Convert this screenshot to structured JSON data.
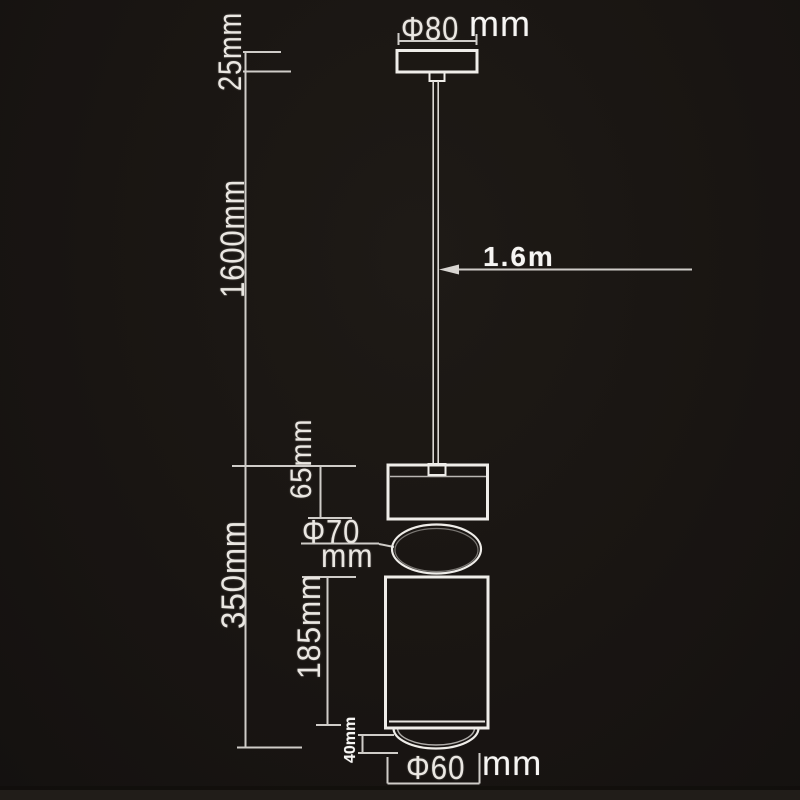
{
  "page": {
    "background": "#191512",
    "dim_line_color": "#cfccc8",
    "shape_line_color": "#efede9",
    "text_color": "#eae7e2"
  },
  "diagram": {
    "type": "pendant-lamp-dimension-drawing",
    "dimensions": {
      "canopy_diameter": {
        "value": "Φ80",
        "unit": "mm"
      },
      "canopy_height": "25mm",
      "cable_length": "1600mm",
      "cable_length_meters": "1.6m",
      "head_height": "65mm",
      "sphere_diameter": {
        "value": "Φ70",
        "unit": "mm"
      },
      "lamp_height": "350mm",
      "body_height": "185mm",
      "dome_height": "40mm",
      "bottom_diameter": {
        "value": "Φ60",
        "unit": "mm"
      }
    }
  }
}
